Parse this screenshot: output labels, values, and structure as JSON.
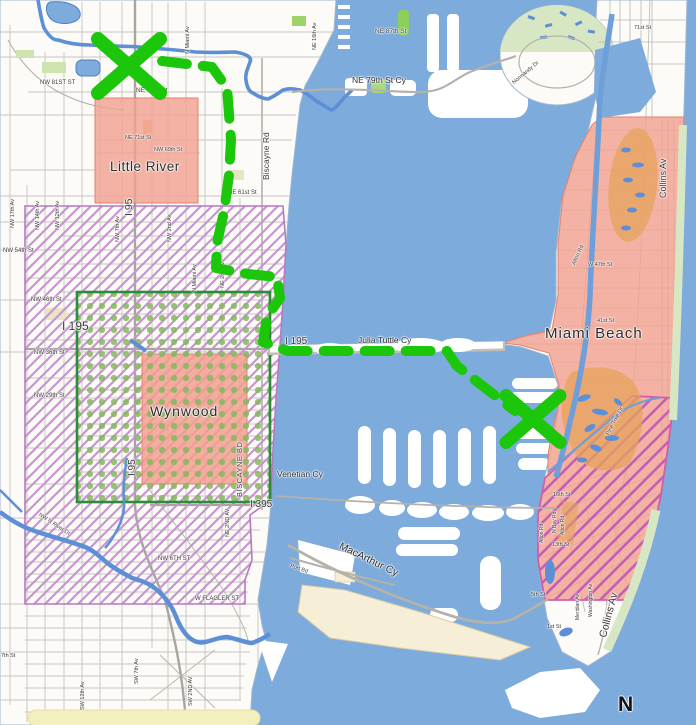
{
  "map": {
    "title": "Miami and Miami Beach map with highlighted zones and green dashed route",
    "colors": {
      "water": "#7dabdb",
      "land": "#fcfbf8",
      "zone_salmon": "#f1a08e",
      "zone_orange": "#e5a35c",
      "hatch_lavender": "#c795cf",
      "hatch_magenta": "#c45fb4",
      "dots_green": "#84b75f",
      "dot_zone_border_green": "#2e8b3a",
      "route_green": "#1cc60a",
      "park_green": "#d8e7c3",
      "port_cream": "#f6eed7",
      "road_yellow": "#f4efbe"
    },
    "zones": [
      {
        "name": "Little River",
        "style": "solid-salmon"
      },
      {
        "name": "Wynwood",
        "style": "solid-salmon"
      },
      {
        "name": "Miami Beach north",
        "style": "solid-salmon-with-orange"
      },
      {
        "name": "South Beach",
        "style": "salmon-with-magenta-hatch"
      },
      {
        "name": "West mainland zone",
        "style": "lavender-diagonal-hatch"
      },
      {
        "name": "Midtown dotted zone",
        "style": "green-dots-green-border"
      }
    ],
    "labels": [
      {
        "t": "NE 87th St",
        "x": 375,
        "y": 29,
        "r": 0,
        "s": 6.5
      },
      {
        "t": "NE 16th Av",
        "x": 313,
        "y": 50,
        "r": -90,
        "s": 5.5
      },
      {
        "t": "N Miami Av",
        "x": 186,
        "y": 54,
        "r": -90,
        "s": 5.5
      },
      {
        "t": "71st St",
        "x": 634,
        "y": 26,
        "r": 0,
        "s": 5.5
      },
      {
        "t": "Normandy Dr",
        "x": 512,
        "y": 82,
        "r": -40,
        "s": 5.5
      },
      {
        "t": "NE 79th St Cy",
        "x": 352,
        "y": 76,
        "r": 0,
        "s": 8.5,
        "c": "#2e2e2e"
      },
      {
        "t": "NW 81ST ST",
        "x": 40,
        "y": 80,
        "r": 0,
        "s": 6
      },
      {
        "t": "NE 79th St",
        "x": 136,
        "y": 88,
        "r": 0,
        "s": 6.5
      },
      {
        "t": "Biscayne Rd",
        "x": 262,
        "y": 180,
        "r": -90,
        "s": 8.5
      },
      {
        "t": "NE 71st St",
        "x": 125,
        "y": 136,
        "r": 0,
        "s": 5.5
      },
      {
        "t": "NW 69th St",
        "x": 154,
        "y": 148,
        "r": 0,
        "s": 5.5
      },
      {
        "t": "Little River",
        "x": 110,
        "y": 160,
        "r": 0,
        "s": 13.5,
        "c": "#2b2b2b",
        "ls": 0.5
      },
      {
        "t": "I 95",
        "x": 124,
        "y": 216,
        "r": -90,
        "s": 10.5
      },
      {
        "t": "NE 61st St",
        "x": 228,
        "y": 190,
        "r": 0,
        "s": 6
      },
      {
        "t": "NW 17th Av",
        "x": 11,
        "y": 228,
        "r": -90,
        "s": 5.5
      },
      {
        "t": "NW 14th Av",
        "x": 36,
        "y": 230,
        "r": -90,
        "s": 5.5
      },
      {
        "t": "NW 12th Av",
        "x": 56,
        "y": 230,
        "r": -90,
        "s": 5.5
      },
      {
        "t": "NW 7th Av",
        "x": 116,
        "y": 242,
        "r": -90,
        "s": 5.5
      },
      {
        "t": "NW 2nd Av",
        "x": 168,
        "y": 242,
        "r": -90,
        "s": 5.5
      },
      {
        "t": "NW 54th St",
        "x": 3,
        "y": 248,
        "r": 0,
        "s": 6
      },
      {
        "t": "N Miami Av",
        "x": 193,
        "y": 292,
        "r": -90,
        "s": 5.5
      },
      {
        "t": "NE 2nd Av",
        "x": 221,
        "y": 288,
        "r": -90,
        "s": 5.5
      },
      {
        "t": "Collins Av",
        "x": 659,
        "y": 198,
        "r": -90,
        "s": 9
      },
      {
        "t": "NW 46th St",
        "x": 31,
        "y": 297,
        "r": 0,
        "s": 6
      },
      {
        "t": "I 195",
        "x": 62,
        "y": 320,
        "r": 0,
        "s": 12
      },
      {
        "t": "Alton Rd",
        "x": 572,
        "y": 264,
        "r": -65,
        "s": 5.5
      },
      {
        "t": "W 47th St",
        "x": 588,
        "y": 263,
        "r": 0,
        "s": 5.5
      },
      {
        "t": "41st St",
        "x": 597,
        "y": 319,
        "r": 0,
        "s": 5.5
      },
      {
        "t": "Miami Beach",
        "x": 545,
        "y": 326,
        "r": 0,
        "s": 15,
        "c": "#2b2b2b",
        "ls": 1
      },
      {
        "t": "NW 36th St",
        "x": 34,
        "y": 350,
        "r": 0,
        "s": 6
      },
      {
        "t": "I 195",
        "x": 285,
        "y": 337,
        "r": 0,
        "s": 10
      },
      {
        "t": "Julia Tuttle Cy",
        "x": 358,
        "y": 336,
        "r": 0,
        "s": 8.5,
        "c": "#2e2e2e"
      },
      {
        "t": "NW 29th St",
        "x": 34,
        "y": 393,
        "r": 0,
        "s": 6
      },
      {
        "t": "Pine Tree Dr",
        "x": 606,
        "y": 434,
        "r": -62,
        "s": 5.5
      },
      {
        "t": "Wynwood",
        "x": 150,
        "y": 404,
        "r": 0,
        "s": 14,
        "c": "#2b2b2b",
        "ls": 1
      },
      {
        "t": "BISCAYNE BD",
        "x": 236,
        "y": 497,
        "r": -90,
        "s": 7.5,
        "ls": 0.5
      },
      {
        "t": "I 95",
        "x": 128,
        "y": 476,
        "r": -90,
        "s": 10
      },
      {
        "t": "N Bay Rd",
        "x": 553,
        "y": 533,
        "r": -90,
        "s": 5
      },
      {
        "t": "Alton Rd",
        "x": 561,
        "y": 535,
        "r": -90,
        "s": 5
      },
      {
        "t": "Venetian Cy",
        "x": 277,
        "y": 470,
        "r": 0,
        "s": 8.5,
        "c": "#2e2e2e"
      },
      {
        "t": "I 395",
        "x": 250,
        "y": 500,
        "r": 0,
        "s": 10
      },
      {
        "t": "NE 2ND AV",
        "x": 226,
        "y": 537,
        "r": -90,
        "s": 5.5
      },
      {
        "t": "NW N River Dr",
        "x": 40,
        "y": 513,
        "r": 33,
        "s": 5.5
      },
      {
        "t": "NW 6TH ST",
        "x": 158,
        "y": 556,
        "r": 0,
        "s": 6
      },
      {
        "t": "16th St",
        "x": 553,
        "y": 493,
        "r": 0,
        "s": 5.5
      },
      {
        "t": "W FLAGLER ST",
        "x": 195,
        "y": 596,
        "r": 0,
        "s": 6
      },
      {
        "t": "Port Bd",
        "x": 291,
        "y": 564,
        "r": 20,
        "s": 5.5
      },
      {
        "t": "MacArthur Cy",
        "x": 342,
        "y": 541,
        "r": 26,
        "s": 10.5,
        "c": "#2e2e2e"
      },
      {
        "t": "13th St",
        "x": 552,
        "y": 543,
        "r": 0,
        "s": 5.5
      },
      {
        "t": "Alton Rd",
        "x": 540,
        "y": 543,
        "r": -90,
        "s": 5
      },
      {
        "t": "Collins Av",
        "x": 598,
        "y": 636,
        "r": -75,
        "s": 10.5
      },
      {
        "t": "Meridian Av",
        "x": 576,
        "y": 620,
        "r": -90,
        "s": 5
      },
      {
        "t": "Washington Av",
        "x": 589,
        "y": 617,
        "r": -90,
        "s": 5
      },
      {
        "t": "5th St",
        "x": 531,
        "y": 593,
        "r": 0,
        "s": 5.5
      },
      {
        "t": "1st St",
        "x": 547,
        "y": 625,
        "r": 0,
        "s": 5.5
      },
      {
        "t": "7th St",
        "x": 1,
        "y": 654,
        "r": 0,
        "s": 5.5
      },
      {
        "t": "SW 12th Av",
        "x": 81,
        "y": 710,
        "r": -90,
        "s": 5.5
      },
      {
        "t": "SW 7th Av",
        "x": 135,
        "y": 684,
        "r": -90,
        "s": 5.5
      },
      {
        "t": "SW 2ND AV",
        "x": 189,
        "y": 706,
        "r": -90,
        "s": 5.5
      },
      {
        "t": "N",
        "x": 618,
        "y": 694,
        "r": 0,
        "s": 21,
        "w": "bold",
        "c": "#111111"
      }
    ],
    "annotation": {
      "color": "#1cc60a",
      "stroke_width": 10,
      "dash": "25 16",
      "route_path": [
        [
          162,
          61
        ],
        [
          212,
          67
        ],
        [
          227,
          88
        ],
        [
          231,
          140
        ],
        [
          229,
          175
        ],
        [
          224,
          212
        ],
        [
          217,
          243
        ],
        [
          216,
          268
        ],
        [
          248,
          274
        ],
        [
          277,
          277
        ],
        [
          280,
          298
        ],
        [
          267,
          317
        ],
        [
          263,
          342
        ],
        [
          288,
          351
        ],
        [
          447,
          351
        ],
        [
          457,
          366
        ],
        [
          515,
          411
        ]
      ],
      "x_marks": [
        {
          "x": 129,
          "y": 66,
          "arm": 31,
          "stroke": 14
        },
        {
          "x": 533,
          "y": 419,
          "arm": 27,
          "stroke": 13
        }
      ]
    }
  }
}
